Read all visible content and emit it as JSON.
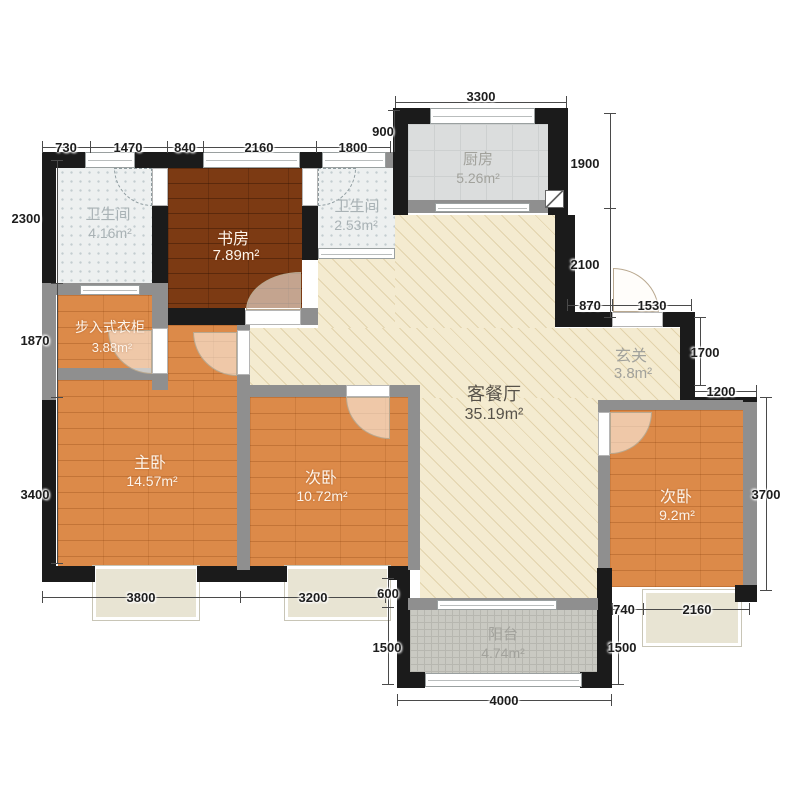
{
  "rooms": {
    "bath1": {
      "name": "卫生间",
      "area": "4.16m²"
    },
    "study": {
      "name": "书房",
      "area": "7.89m²"
    },
    "bath2": {
      "name": "卫生间",
      "area": "2.53m²"
    },
    "kitchen": {
      "name": "厨房",
      "area": "5.26m²"
    },
    "living": {
      "name": "客餐厅",
      "area": "35.19m²"
    },
    "entry": {
      "name": "玄关",
      "area": "3.8m²"
    },
    "closet": {
      "name": "步入式衣柜",
      "area": "3.88m²"
    },
    "master": {
      "name": "主卧",
      "area": "14.57m²"
    },
    "bed2": {
      "name": "次卧",
      "area": "10.72m²"
    },
    "bed3": {
      "name": "次卧",
      "area": "9.2m²"
    },
    "balcony": {
      "name": "阳台",
      "area": "4.74m²"
    }
  },
  "dims": {
    "top_3300": "3300",
    "top_900": "900",
    "top_730": "730",
    "top_1470": "1470",
    "top_840": "840",
    "top_2160": "2160",
    "top_1800": "1800",
    "left_2300": "2300",
    "left_1870": "1870",
    "left_3400": "3400",
    "right_1900": "1900",
    "right_2100": "2100",
    "entry_870": "870",
    "entry_1530": "1530",
    "entry_1700": "1700",
    "entry_1200": "1200",
    "right_3700": "3700",
    "bottom_3800": "3800",
    "bottom_3200": "3200",
    "balcony_600": "600",
    "balcony_left_1500": "1500",
    "balcony_4000": "4000",
    "bed3_740": "740",
    "bed3_2160": "2160",
    "balcony_right_1500": "1500"
  },
  "palette": {
    "wall": "#1b1b1b",
    "partition": "#8f8f8f",
    "wood_floor": "#dc8a49",
    "study_floor": "#7c3a13",
    "tile_floor": "#edf0f0",
    "kitchen_floor": "#dbdddd",
    "living_floor": "#f4ebd0",
    "balcony_floor": "#c9c9c2",
    "dim_text": "#1d1d1d"
  }
}
